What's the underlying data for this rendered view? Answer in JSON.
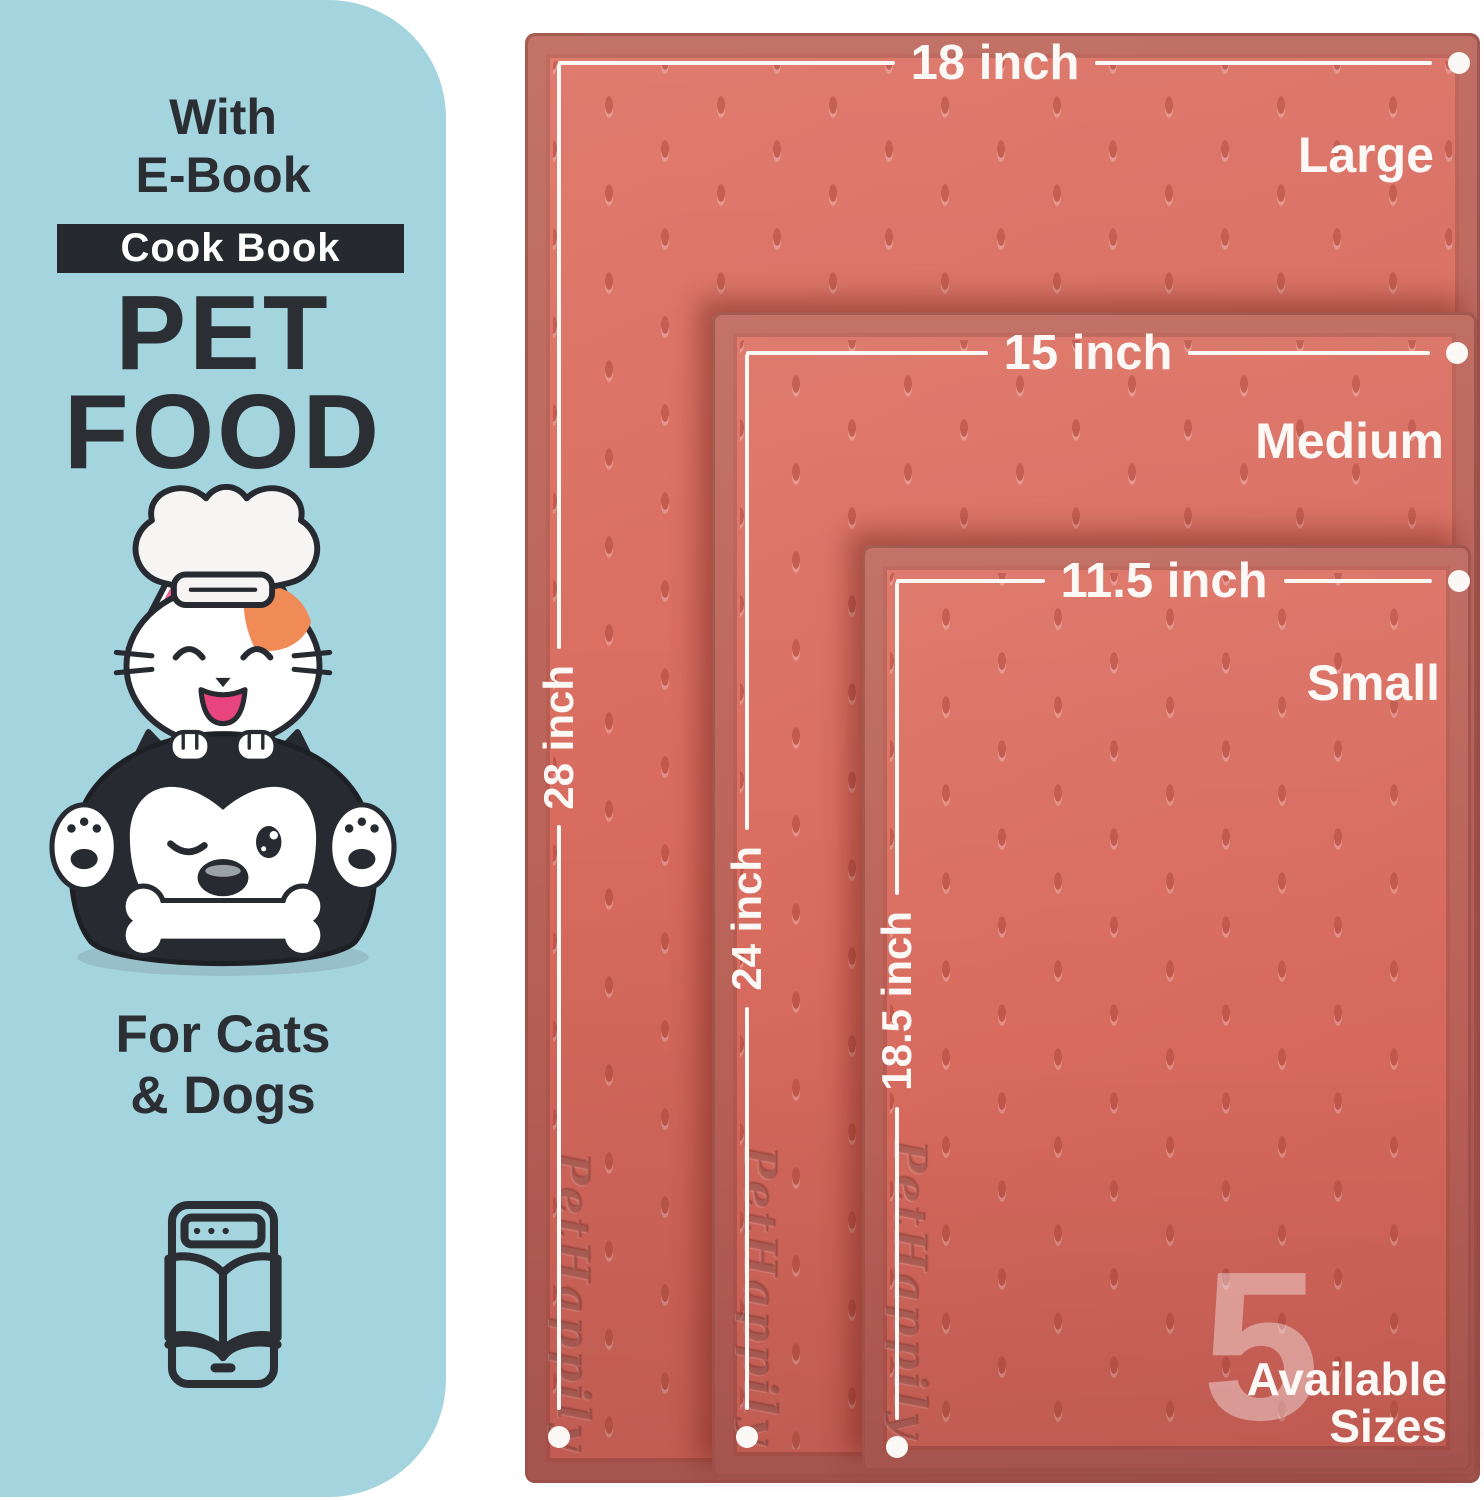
{
  "colors": {
    "panel_bg": "#a4d4de",
    "ink": "#2b2f34",
    "mat": "#d8695d",
    "annotation_white": "#fcf8f5",
    "patch_orange": "#f08a56",
    "ear_pink": "#ee5f92"
  },
  "panel": {
    "intro_line1": "With",
    "intro_line2": "E-Book",
    "badge_label": "Cook Book",
    "title_line1": "PET",
    "title_line2": "FOOD",
    "audience_line1": "For Cats",
    "audience_line2": "& Dogs"
  },
  "mats": {
    "brand_embossed": "PetHappily",
    "sizes": [
      {
        "name": "Large",
        "width": "18 inch",
        "height": "28 inch"
      },
      {
        "name": "Medium",
        "width": "15 inch",
        "height": "24 inch"
      },
      {
        "name": "Small",
        "width": "11.5 inch",
        "height": "18.5 inch"
      }
    ]
  },
  "availability": {
    "count": "5",
    "line1": "Available",
    "line2": "Sizes"
  }
}
